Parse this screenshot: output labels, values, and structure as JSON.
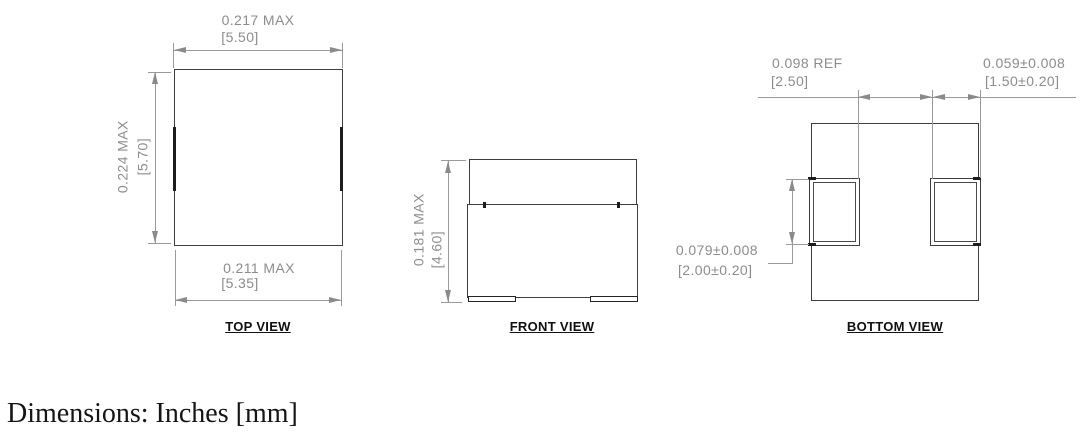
{
  "footer": {
    "text": "Dimensions: Inches [mm]"
  },
  "top_view": {
    "label": "TOP VIEW",
    "width_top": {
      "in": "0.217 MAX",
      "mm": "[5.50]"
    },
    "height": {
      "in": "0.224 MAX",
      "mm": "[5.70]"
    },
    "width_bottom": {
      "in": "0.211 MAX",
      "mm": "[5.35]"
    }
  },
  "front_view": {
    "label": "FRONT VIEW",
    "height": {
      "in": "0.181 MAX",
      "mm": "[4.60]"
    }
  },
  "bottom_view": {
    "label": "BOTTOM VIEW",
    "pad_gap": {
      "in": "0.098 REF",
      "mm": "[2.50]"
    },
    "pad_width": {
      "in": "0.059±0.008",
      "mm": "[1.50±0.20]"
    },
    "pad_height": {
      "in": "0.079±0.008",
      "mm": "[2.00±0.20]"
    }
  },
  "colors": {
    "object_line": "#3e3e3e",
    "terminal_line": "#1d1d1d",
    "dimension_line": "#9a9a9a",
    "dimension_text": "#8c8c8c",
    "label_text": "#101010"
  }
}
